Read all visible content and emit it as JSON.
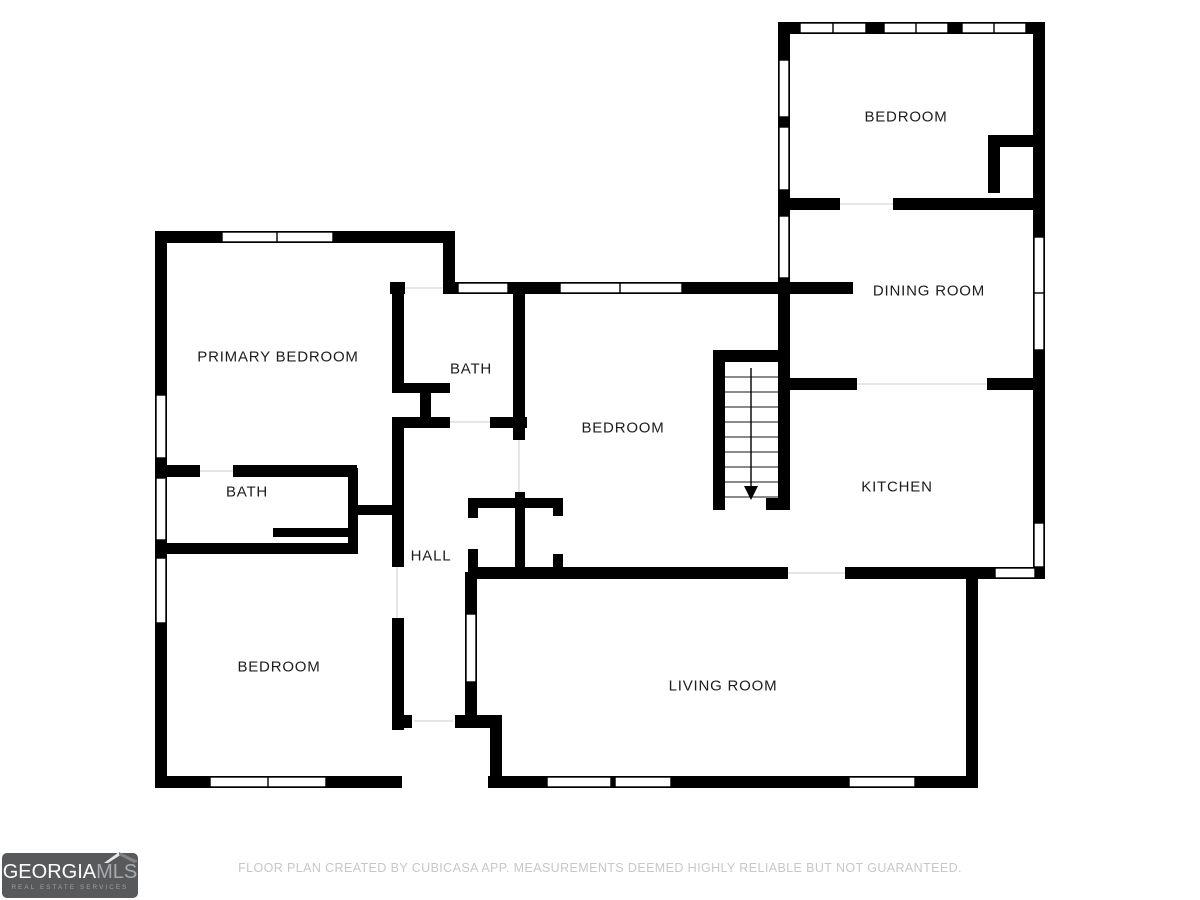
{
  "plan": {
    "rooms": [
      {
        "name": "BEDROOM"
      },
      {
        "name": "DINING ROOM"
      },
      {
        "name": "KITCHEN"
      },
      {
        "name": "BEDROOM"
      },
      {
        "name": "BATH"
      },
      {
        "name": "PRIMARY BEDROOM"
      },
      {
        "name": "BATH"
      },
      {
        "name": "HALL"
      },
      {
        "name": "BEDROOM"
      },
      {
        "name": "LIVING ROOM"
      }
    ],
    "stairs": {
      "direction": "down"
    },
    "colors": {
      "wall": "#000000",
      "floor": "#ffffff",
      "threshold": "#d6d6d6"
    }
  },
  "footer": {
    "disclaimer": "FLOOR PLAN CREATED BY CUBICASA APP. MEASUREMENTS DEEMED HIGHLY RELIABLE BUT NOT GUARANTEED."
  },
  "logo": {
    "brand": "GEORGIA",
    "suffix": "MLS",
    "tagline": "REAL ESTATE SERVICES",
    "background": "#58595b",
    "brand_color": "#ffffff",
    "suffix_color": "#a7a9ac",
    "tagline_color": "#9fa1a4"
  }
}
